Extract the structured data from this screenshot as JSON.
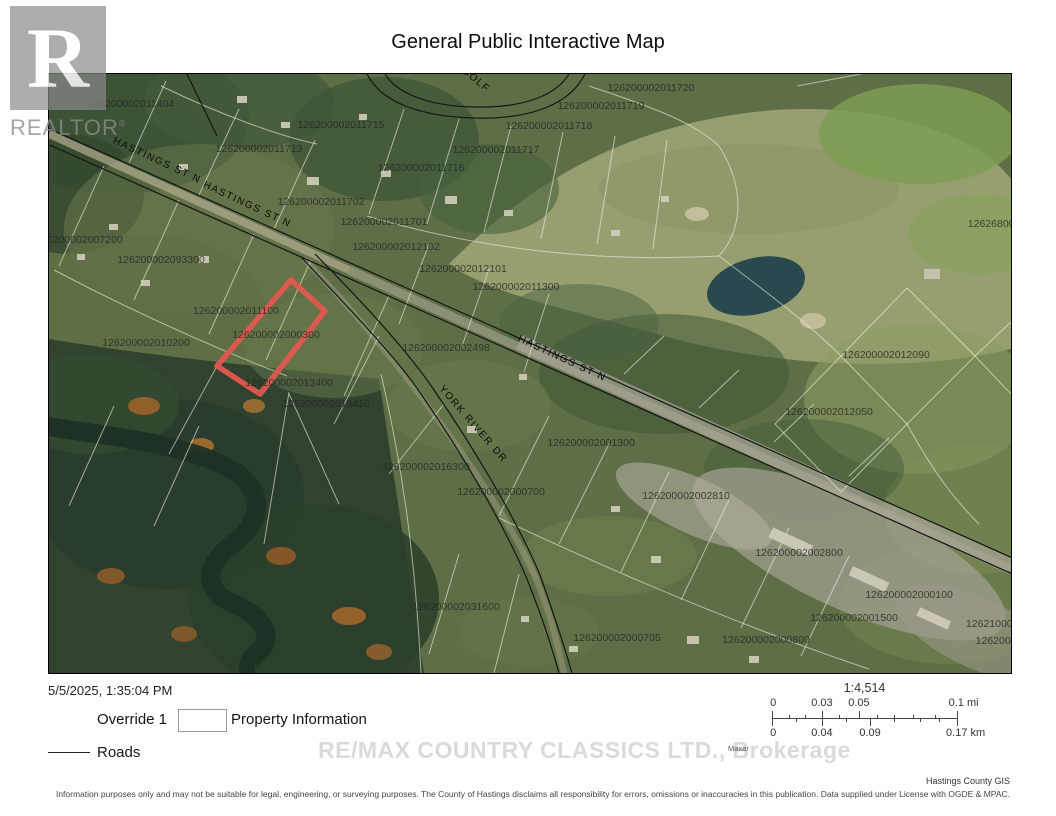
{
  "header": {
    "title": "General Public Interactive Map"
  },
  "realtor": {
    "letter": "R",
    "word": "REALTOR",
    "reg_mark": "®"
  },
  "colors": {
    "override_red": "#b5443f",
    "map_override_red": "#e2574f",
    "roads_black": "#222222"
  },
  "map": {
    "road_labels": [
      {
        "text": "HASTINGS ST N",
        "x": 107,
        "y": 89,
        "rot": 25
      },
      {
        "text": "HASTINGS ST N",
        "x": 197,
        "y": 133,
        "rot": 25
      },
      {
        "text": "HASTINGS ST N",
        "x": 512,
        "y": 287,
        "rot": 25
      },
      {
        "text": "YORK RIVER DR",
        "x": 422,
        "y": 352,
        "rot": 49
      },
      {
        "text": "GOLF",
        "x": 425,
        "y": 8,
        "rot": 40
      }
    ],
    "parcel_labels": [
      {
        "text": "126200002011404",
        "x": 82,
        "y": 33
      },
      {
        "text": "126200002011713",
        "x": 210,
        "y": 78
      },
      {
        "text": "126200002011715",
        "x": 292,
        "y": 54
      },
      {
        "text": "126200002011716",
        "x": 372,
        "y": 97
      },
      {
        "text": "126200002011717",
        "x": 447,
        "y": 79
      },
      {
        "text": "126200002011718",
        "x": 500,
        "y": 55
      },
      {
        "text": "126200002011719",
        "x": 552,
        "y": 35
      },
      {
        "text": "126200002011720",
        "x": 602,
        "y": 17
      },
      {
        "text": "126200002011702",
        "x": 272,
        "y": 131
      },
      {
        "text": "126200002011701",
        "x": 335,
        "y": 151
      },
      {
        "text": "126200002012102",
        "x": 347,
        "y": 176
      },
      {
        "text": "126200002012101",
        "x": 414,
        "y": 198
      },
      {
        "text": "126200002011300",
        "x": 467,
        "y": 216
      },
      {
        "text": "126200002002498",
        "x": 397,
        "y": 277
      },
      {
        "text": "1262680024",
        "x": 948,
        "y": 153
      },
      {
        "text": "126200002012090",
        "x": 837,
        "y": 284
      },
      {
        "text": "126200002012050",
        "x": 780,
        "y": 341
      },
      {
        "text": "126200002007200",
        "x": 30,
        "y": 169
      },
      {
        "text": "126200002093300",
        "x": 112,
        "y": 189
      },
      {
        "text": "126200002011100",
        "x": 187,
        "y": 240
      },
      {
        "text": "126200002000300",
        "x": 227,
        "y": 264
      },
      {
        "text": "126200002010200",
        "x": 97,
        "y": 272
      },
      {
        "text": "126200002013400",
        "x": 240,
        "y": 312
      },
      {
        "text": "126200002013410",
        "x": 277,
        "y": 333
      },
      {
        "text": "126200002001300",
        "x": 542,
        "y": 372
      },
      {
        "text": "126200002016300",
        "x": 377,
        "y": 396
      },
      {
        "text": "126200002000700",
        "x": 452,
        "y": 421
      },
      {
        "text": "126200002002810",
        "x": 637,
        "y": 425
      },
      {
        "text": "126200002002800",
        "x": 750,
        "y": 482
      },
      {
        "text": "126200002000100",
        "x": 860,
        "y": 524
      },
      {
        "text": "126200002001500",
        "x": 805,
        "y": 547
      },
      {
        "text": "126200002031600",
        "x": 407,
        "y": 536
      },
      {
        "text": "126200002000705",
        "x": 568,
        "y": 567
      },
      {
        "text": "126200002000800",
        "x": 717,
        "y": 569
      },
      {
        "text": "126210002603",
        "x": 952,
        "y": 553
      },
      {
        "text": "12620002",
        "x": 950,
        "y": 570
      }
    ]
  },
  "legend": {
    "timestamp": "5/5/2025, 1:35:04 PM",
    "override_label": "Override 1",
    "property_label": "Property Information",
    "roads_label": "Roads"
  },
  "scale": {
    "ratio": "1:4,514",
    "mi": [
      {
        "label": "0",
        "pos": 0
      },
      {
        "label": "0.03",
        "pos": 27
      },
      {
        "label": "0.05",
        "pos": 47
      },
      {
        "label": "0.1 mi",
        "pos": 100
      }
    ],
    "km": [
      {
        "label": "0",
        "pos": 0
      },
      {
        "label": "0.04",
        "pos": 27
      },
      {
        "label": "0.09",
        "pos": 53
      },
      {
        "label": "0.17 km",
        "pos": 100
      }
    ]
  },
  "watermark": {
    "brokerage": "RE/MAX COUNTRY CLASSICS LTD., Brokerage",
    "imagery": "Maxar"
  },
  "footer": {
    "credit": "Hastings County GIS",
    "disclaimer": "Information purposes only and may not be suitable for legal, engineering, or surveying purposes.  The County of Hastings disclaims all responsibility for errors, omissions or inaccuracies in this publication. Data supplied under License with OGDE & MPAC."
  }
}
